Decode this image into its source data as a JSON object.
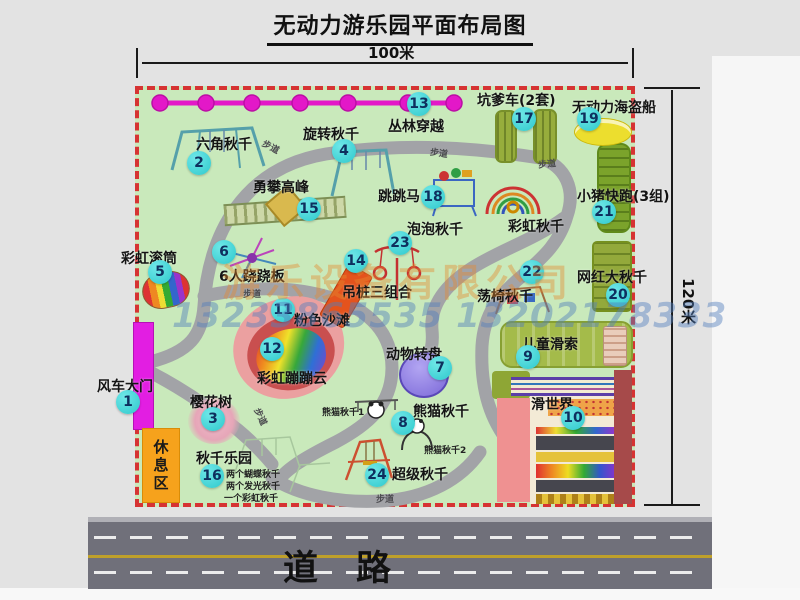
{
  "title": "无动力游乐园平面布局图",
  "dimension_labels": {
    "width": "100米",
    "height": "120米"
  },
  "road_label": "道路",
  "rest_area_label": "休息区",
  "watermarks": {
    "company": "游乐设备有限公司",
    "phone": "13233865535 13202178333"
  },
  "footpath_labels": [
    "步道",
    "步道",
    "步道",
    "步道",
    "步道",
    "步道"
  ],
  "attractions": [
    {
      "id": 1,
      "name": "风车大门"
    },
    {
      "id": 2,
      "name": "六角秋千"
    },
    {
      "id": 3,
      "name": "樱花树"
    },
    {
      "id": 4,
      "name": "旋转秋千"
    },
    {
      "id": 5,
      "name": "彩虹滚筒"
    },
    {
      "id": 6,
      "name": "6人跷跷板"
    },
    {
      "id": 7,
      "name": "动物转盘"
    },
    {
      "id": 8,
      "name": "熊猫秋千"
    },
    {
      "id": 9,
      "name": "儿童滑索"
    },
    {
      "id": 10,
      "name": "滑世界"
    },
    {
      "id": 11,
      "name": "粉色沙滩"
    },
    {
      "id": 12,
      "name": "彩虹蹦蹦云"
    },
    {
      "id": 13,
      "name": "丛林穿越"
    },
    {
      "id": 14,
      "name": "吊桩三组合"
    },
    {
      "id": 15,
      "name": "勇攀高峰"
    },
    {
      "id": 16,
      "name": "秋千乐园"
    },
    {
      "id": 17,
      "name": "坑爹车(2套)"
    },
    {
      "id": 18,
      "name": "跳跳马"
    },
    {
      "id": 19,
      "name": "无动力海盗船"
    },
    {
      "id": 20,
      "name": "网红大秋千"
    },
    {
      "id": 21,
      "name": "小猪快跑(3组)"
    },
    {
      "id": 22,
      "name": "荡椅秋千"
    },
    {
      "id": 23,
      "name": "泡泡秋千"
    },
    {
      "id": 24,
      "name": "超级秋千"
    }
  ],
  "extra_labels": {
    "rainbow_swing": "彩虹秋千",
    "panda_swing_1": "熊猫秋千1",
    "panda_swing_2": "熊猫秋千2"
  },
  "swing_park_notes": [
    "两个蝴蝶秋千",
    "两个发光秋千",
    "一个彩虹秋千"
  ],
  "colors": {
    "map_bg": "#c9e9bb",
    "border_dash": "#d63333",
    "badge": "#38d3d5",
    "gate": "#e21ee2",
    "zipline": "#e318c8",
    "path": "#a2a3a7",
    "rest_area": "#f6a21c",
    "road": "#70707a"
  }
}
